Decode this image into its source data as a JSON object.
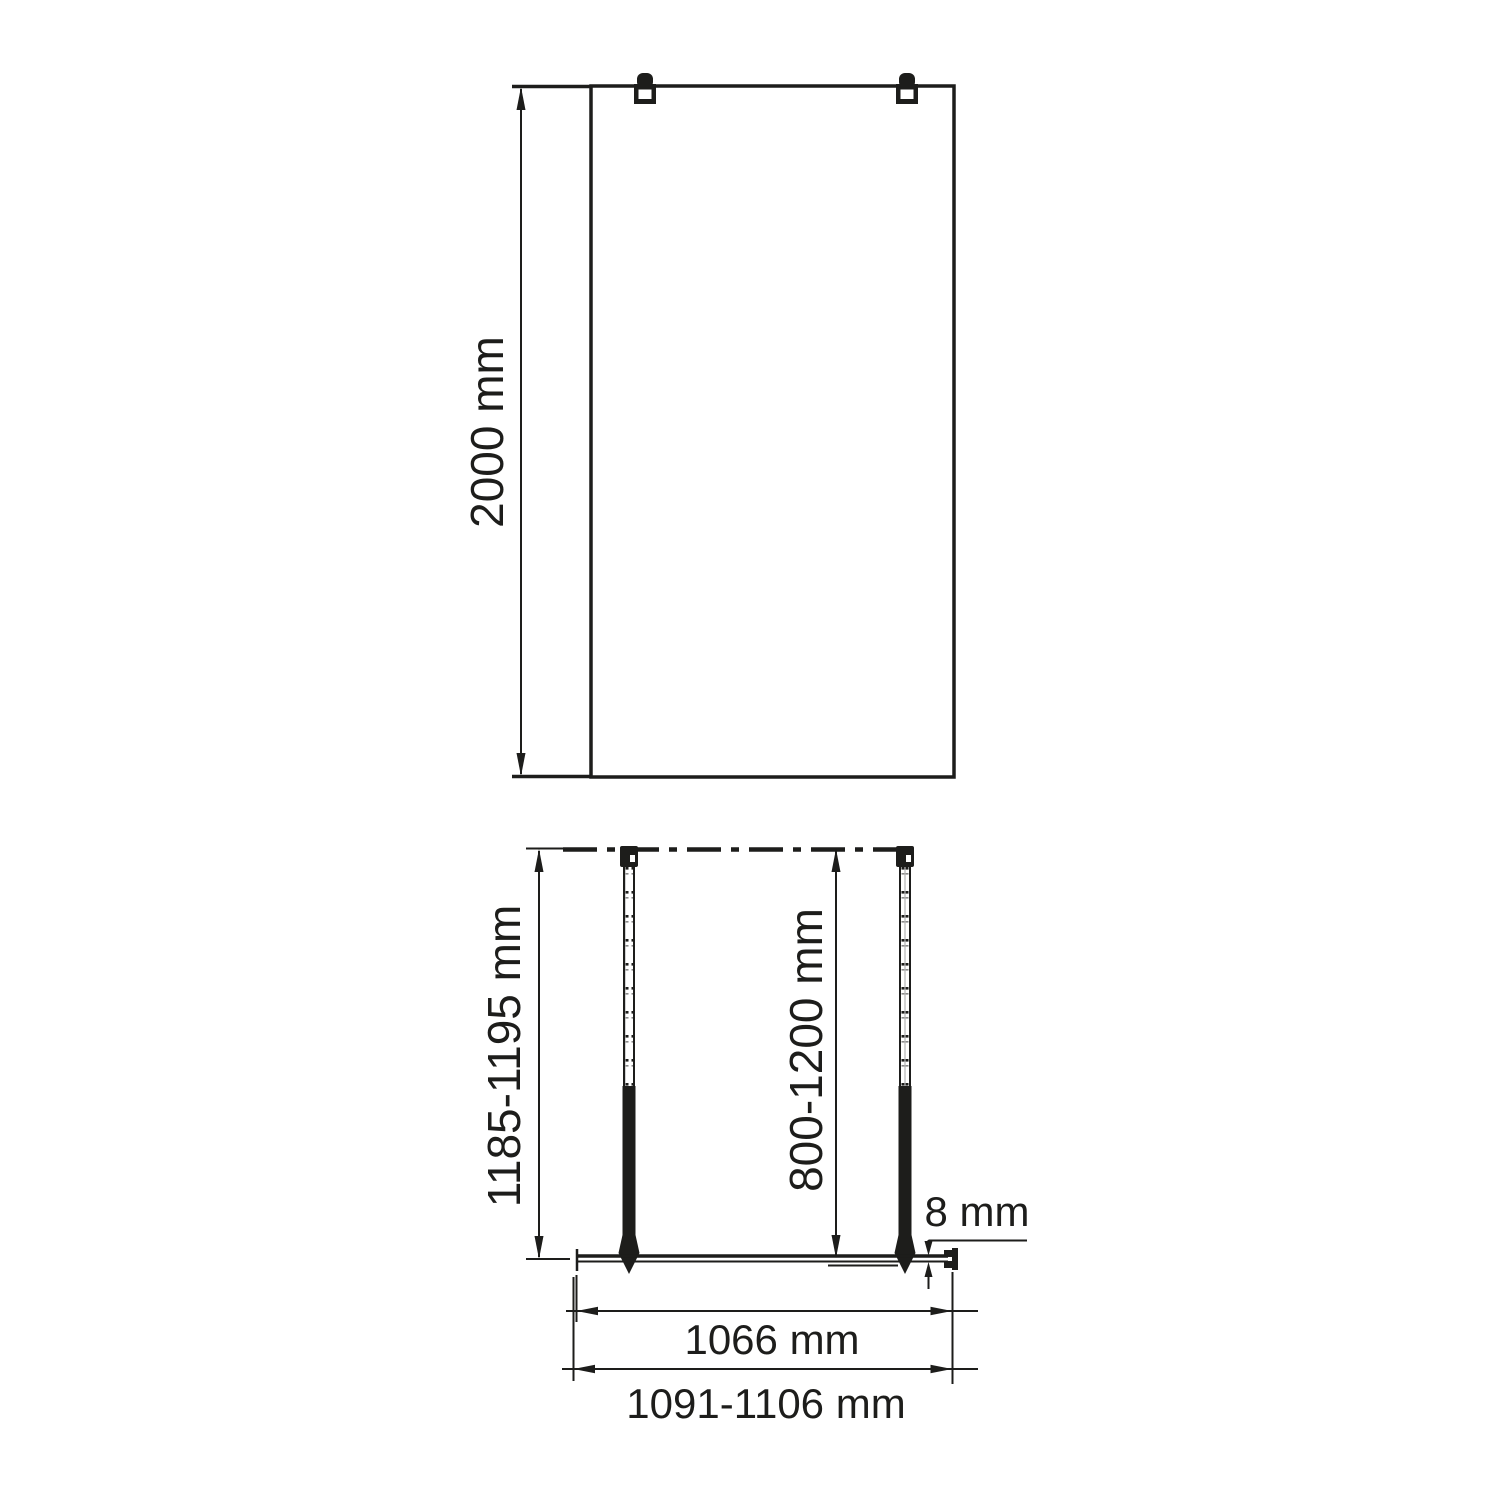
{
  "drawing": {
    "type": "walk-in shower glass screen installation dimensions",
    "front_view": {
      "height_label": "2000 mm"
    },
    "plan_view": {
      "overall_depth_label": "1185-1195 mm",
      "support_bar_range_label": "800-1200 mm",
      "glass_thickness_label": "8 mm",
      "glass_width_label": "1066 mm",
      "overall_width_label": "1091-1106 mm"
    },
    "colors": {
      "line": "#1d1d1b",
      "background": "#ffffff"
    }
  }
}
